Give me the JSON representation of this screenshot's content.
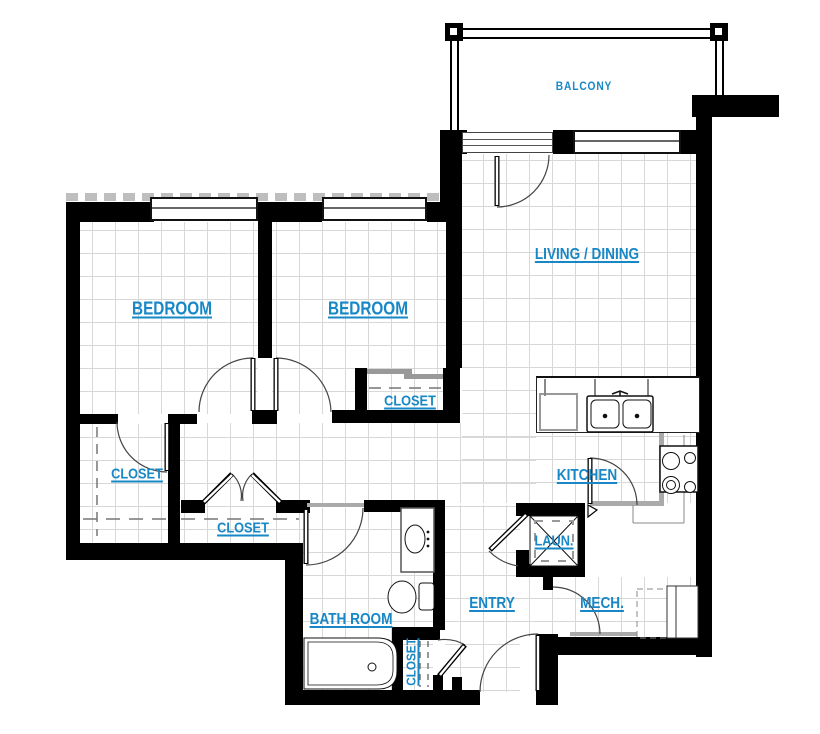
{
  "title": "Apartment Floor Plan",
  "rooms": {
    "balcony": {
      "label": "BALCONY"
    },
    "living_dining": {
      "label": "LIVING / DINING"
    },
    "bedroom_1": {
      "label": "BEDROOM"
    },
    "bedroom_2": {
      "label": "BEDROOM"
    },
    "bedroom2_closet": {
      "label": "CLOSET"
    },
    "bedroom1_closet": {
      "label": "CLOSET"
    },
    "hall_closet": {
      "label": "CLOSET"
    },
    "kitchen": {
      "label": "KITCHEN"
    },
    "laundry": {
      "label": "LAUN."
    },
    "entry": {
      "label": "ENTRY"
    },
    "mech": {
      "label": "MECH."
    },
    "bathroom": {
      "label": "BATH ROOM"
    },
    "entry_closet": {
      "label": "CLOSET"
    }
  },
  "colors": {
    "label_blue": "#1787c6",
    "wall": "#000000",
    "grid_line": "#d8d8d8",
    "fixture_gray": "#999999"
  }
}
